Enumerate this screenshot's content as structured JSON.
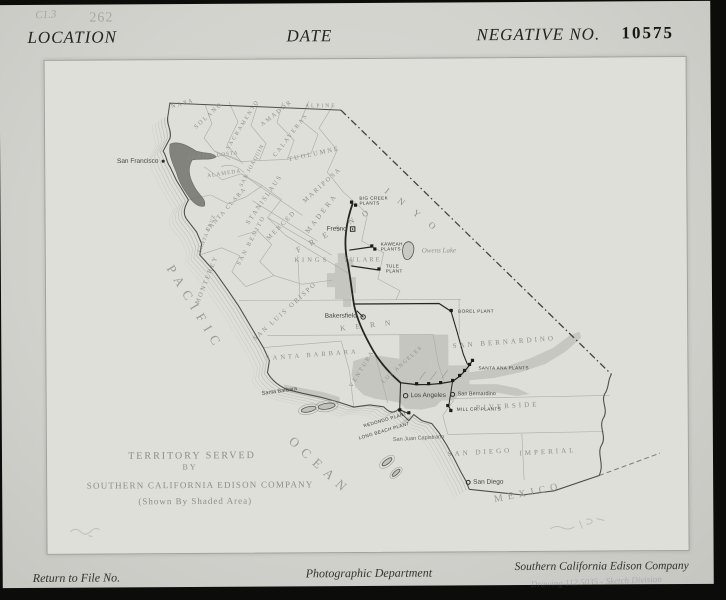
{
  "header": {
    "location_label": "LOCATION",
    "date_label": "DATE",
    "negative_label": "NEGATIVE NO.",
    "negative_number": "10575",
    "file_code": "C1.3",
    "stamp_number": "262"
  },
  "map": {
    "title_block": {
      "line1": "TERRITORY SERVED",
      "line2": "BY",
      "line3": "SOUTHERN CALIFORNIA EDISON COMPANY",
      "line4": "(Shown By Shaded Area)"
    },
    "water_labels": {
      "pacific": "PACIFIC",
      "ocean": "OCEAN",
      "mexico": "MEXICO"
    },
    "lake_label": "Owens Lake",
    "counties": [
      "NAPA",
      "SOLANO",
      "SACRAMENTO",
      "AMADOR",
      "ALPINE",
      "CALAVERAS",
      "TUOLUMNE",
      "MARIPOSA",
      "CONTRA COSTA",
      "SAN JOAQUIN",
      "ALAMEDA",
      "STANISLAUS",
      "SANTA CLARA",
      "SANTA CRUZ",
      "MERCED",
      "MADERA",
      "SAN BENITO",
      "MONTEREY",
      "FRESNO",
      "KINGS",
      "TULARE",
      "INYO",
      "SAN LUIS OBISPO",
      "SANTA BARBARA",
      "VENTURA",
      "KERN",
      "LOS ANGELES",
      "SAN BERNARDINO",
      "RIVERSIDE",
      "SAN DIEGO",
      "IMPERIAL"
    ],
    "towns": [
      "San Francisco",
      "Fresno",
      "Bakersfield",
      "Santa Barbara",
      "Los Angeles",
      "San Bernardino",
      "San Juan Capistrano",
      "San Diego"
    ],
    "plants": [
      "BIG CREEK PLANTS",
      "KAWEAH PLANTS",
      "TULE PLANT",
      "BOREL PLANT",
      "SANTA ANA PLANTS",
      "MILL CR. PLANTS",
      "REDONDO PLANT",
      "LONG BEACH PLANT"
    ]
  },
  "footer": {
    "return_label": "Return to File No.",
    "department": "Photographic Department",
    "company": "Southern California Edison Company",
    "handwritten_note": "Drawing 112 5035 - Sketch Division"
  }
}
